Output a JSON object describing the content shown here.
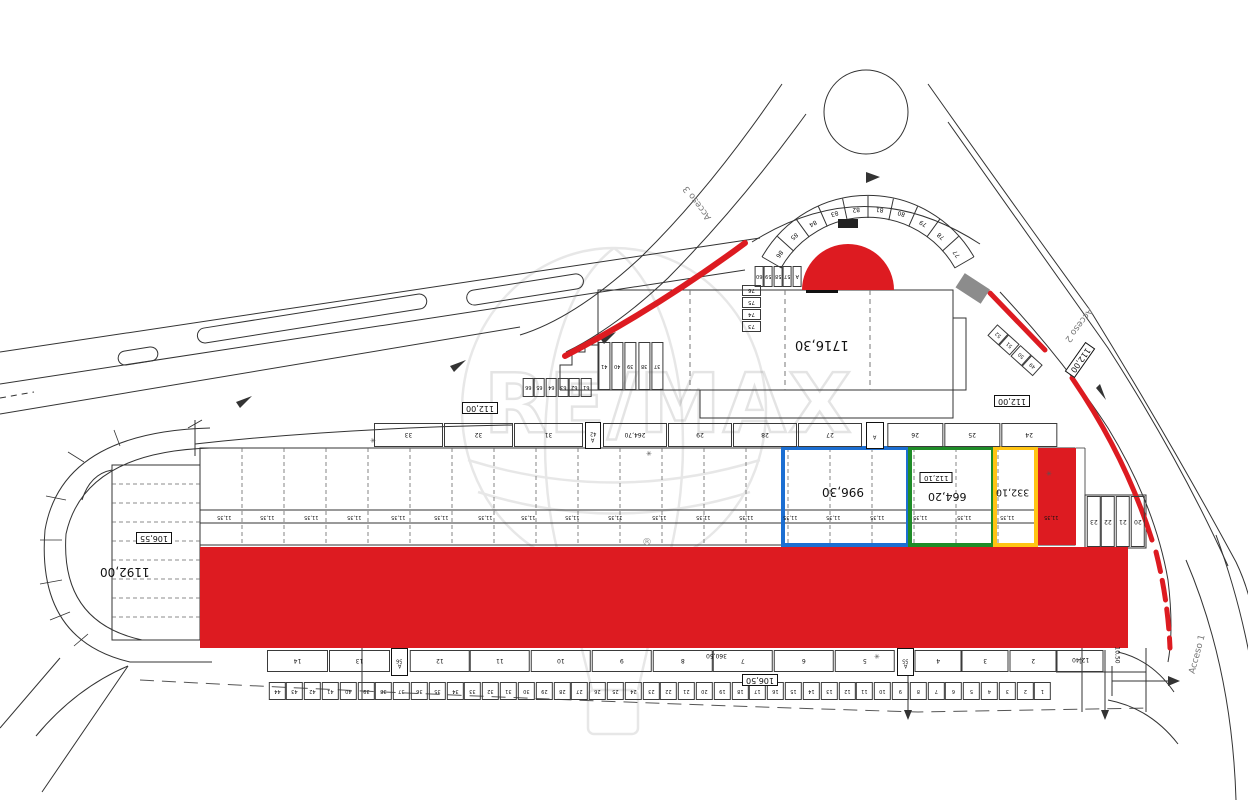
{
  "drawing": {
    "title_watermark": {
      "brand": "RE/MAX",
      "reg": "®"
    },
    "accesses": {
      "a1": "Acceso 1",
      "a2": "Acceso 2",
      "a3": "Acceso 3"
    },
    "areas": {
      "building": "1716,30",
      "left_lot": "1192,00",
      "blue_parcel": "996,30",
      "green_parcel": "664,20",
      "green_parcel_sub": "112,10",
      "yellow_parcel": "332,10"
    },
    "dimensions": {
      "d112_left": "112,00",
      "d112_right": "112,00",
      "d112_diag": "112,00",
      "d106_55": "106,55",
      "d106_50": "106,50",
      "d360_50": "360,50",
      "d264_70": "264,70",
      "d12_40": "12,40",
      "d10_50": "10,50",
      "cell_width": "11,35"
    },
    "colors": {
      "red": "#DD1B21",
      "blue": "#1C6FD2",
      "green": "#1F8C28",
      "yellow": "#FFC413",
      "gray": "#8C8C8C"
    },
    "symbols": {
      "manhole": "✳"
    },
    "stalls": {
      "arc": [
        "86",
        "85",
        "84",
        "83",
        "82",
        "81",
        "80",
        "79",
        "78",
        "77"
      ],
      "col_building": [
        "76",
        "75",
        "74",
        "73"
      ],
      "mid_row": [
        "66",
        "65",
        "64",
        "63",
        "62",
        "61"
      ],
      "dome_row": [
        "60",
        "59",
        "58",
        "57",
        "A"
      ],
      "steps_row": [
        "41",
        "40",
        "39",
        "38",
        "37"
      ],
      "diag_row": [
        "52",
        "51",
        "50",
        "49"
      ],
      "right_col": [
        "23",
        "22",
        "21",
        "20"
      ],
      "top_row_a": [
        "33",
        "32",
        "31"
      ],
      "top_row_b": [
        "264,70",
        "29",
        "28",
        "27"
      ],
      "top_row_c": [
        "26",
        "25",
        "24"
      ],
      "narrow_top": {
        "num": "42",
        "a": "A"
      },
      "narrow_top2": {
        "a": "A"
      },
      "narrow_bottom1": {
        "num": "56",
        "a": "A"
      },
      "narrow_bottom2": {
        "num": "55",
        "a": "A"
      },
      "bottom_wide_a": [
        "14",
        "13"
      ],
      "bottom_wide_b": [
        "12",
        "11",
        "10",
        "9",
        "8",
        "7",
        "6",
        "5"
      ],
      "bottom_wide_c": [
        "4",
        "3",
        "2",
        "1"
      ],
      "bottom_small": [
        "44",
        "43",
        "42",
        "41",
        "40",
        "39",
        "38",
        "37",
        "36",
        "35",
        "34",
        "33",
        "32",
        "31",
        "30",
        "29",
        "28",
        "27",
        "26",
        "25",
        "24",
        "23",
        "22",
        "21",
        "20",
        "19",
        "18",
        "17",
        "16",
        "15",
        "14",
        "13",
        "12",
        "11",
        "10",
        "9",
        "8",
        "7",
        "6",
        "5",
        "4",
        "3",
        "2",
        "1"
      ],
      "cell_dims": [
        "11,35",
        "11,35",
        "11,35",
        "11,35",
        "11,35",
        "11,35",
        "11,35",
        "11,35",
        "11,35",
        "11,35",
        "11,35",
        "11,35",
        "11,35",
        "11,35",
        "11,35",
        "11,35",
        "11,35",
        "11,35",
        "11,35",
        "11,35"
      ]
    }
  }
}
